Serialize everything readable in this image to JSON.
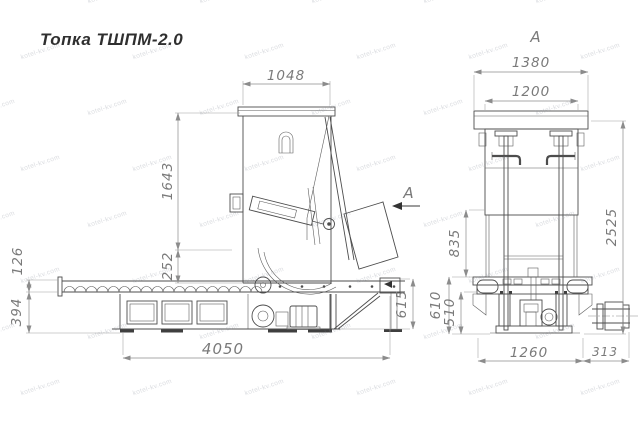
{
  "title": "Топка ТШПМ-2.0",
  "watermark": {
    "text": "kotel-kv.com",
    "rows": 8,
    "cols": 6
  },
  "side_view": {
    "section_arrow_label": "А",
    "dims": {
      "hopper_width": "1048",
      "body_height": "1643",
      "mount_offset": "252",
      "trough_height": "126",
      "ash_box_height": "394",
      "overall_length": "4050",
      "discharge_height": "615"
    }
  },
  "front_view": {
    "view_label": "А",
    "dims": {
      "cover_width": "1380",
      "body_width": "1200",
      "overall_height": "2525",
      "column_height": "835",
      "frame_height": "610",
      "leg_height": "510",
      "base_width": "1260",
      "shaft_length": "313"
    }
  },
  "colors": {
    "line": "#4d4d4d",
    "dimension": "#8c8c8c",
    "dim_text": "#7a7a7a",
    "title_text": "#2f2f2f",
    "background": "#ffffff"
  }
}
